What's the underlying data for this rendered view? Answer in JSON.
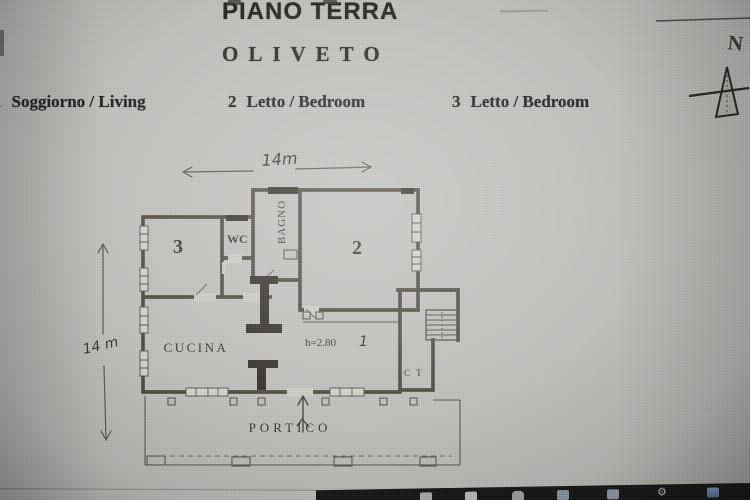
{
  "header": {
    "title": "PIANO TERRA",
    "subtitle": "OLIVETO"
  },
  "legend": {
    "items": [
      {
        "number": "1",
        "label": "Soggiorno / Living"
      },
      {
        "number": "2",
        "label": "Letto / Bedroom"
      },
      {
        "number": "3",
        "label": "Letto / Bedroom"
      }
    ]
  },
  "compass": {
    "north_label": "N"
  },
  "dimensions": {
    "width_label": "14m",
    "height_label": "14 m"
  },
  "plan": {
    "room3": {
      "label": "3"
    },
    "wc": {
      "label": "WC"
    },
    "bagno": {
      "label": "BAGNO"
    },
    "room2": {
      "label": "2"
    },
    "cucina": {
      "label": "CUCINA"
    },
    "living": {
      "number": "1",
      "height_note": "h=2.80"
    },
    "ct": {
      "label": "C T"
    },
    "portico": {
      "label": "PORTICO"
    }
  },
  "taskbar": {
    "icons": [
      "window-icon",
      "document-icon",
      "folder-icon",
      "mail-icon",
      "photos-icon",
      "settings-gear-icon",
      "app-store-icon"
    ]
  },
  "colors": {
    "paper": "#cdccc8",
    "ink": "#2e2b28",
    "taskbar": "#131313",
    "accent_blue": "#5d7ab5"
  }
}
